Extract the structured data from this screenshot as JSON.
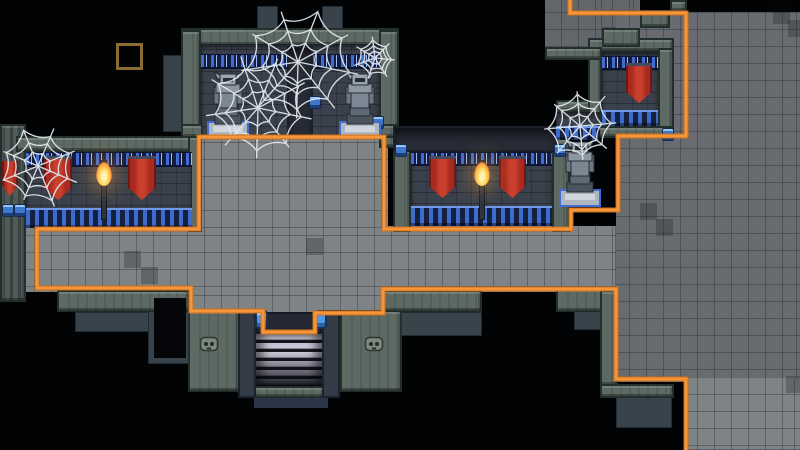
{
  "scene": {
    "width": 800,
    "height": 450,
    "colors": {
      "background": "#020304",
      "floor_light": "#7e8386",
      "floor_dark": "#686c70",
      "floor_dim": "#63676b",
      "wall_cap_green": "#5d6a64",
      "slate": "#39434c",
      "brick": "#3b414c",
      "blue_trim": "#3f6bd2",
      "banner_red": "#a82a20",
      "flame_yellow": "#ffd75e",
      "stair_light": "#c9c5d6",
      "lamp_blue": "#4f9ae6",
      "web_white": "#e3e9ef",
      "outline_orange": "#f7953a",
      "outline_orange_shadow": "#c96f1f",
      "marker_brown": "#8a6b33"
    },
    "floors": [
      {
        "rect": [
          22,
          226,
          598,
          66
        ],
        "tone": "light"
      },
      {
        "rect": [
          190,
          290,
          194,
          24
        ],
        "tone": "light"
      },
      {
        "rect": [
          258,
          312,
          66,
          24
        ],
        "tone": "light"
      },
      {
        "rect": [
          194,
          136,
          194,
          92
        ],
        "tone": "light"
      },
      {
        "rect": [
          545,
          0,
          57,
          47
        ],
        "tone": "dim"
      },
      {
        "rect": [
          602,
          0,
          38,
          28
        ],
        "tone": "dim"
      },
      {
        "rect": [
          616,
          12,
          184,
          370
        ],
        "tone": "dark"
      },
      {
        "rect": [
          686,
          378,
          114,
          72
        ],
        "tone": "light"
      }
    ],
    "dark_tiles": [
      [
        124,
        251
      ],
      [
        141,
        267
      ],
      [
        640,
        203
      ],
      [
        656,
        219
      ],
      [
        773,
        7
      ],
      [
        788,
        20
      ],
      [
        786,
        376
      ],
      [
        306,
        238
      ]
    ],
    "slates": [
      [
        163,
        55,
        20,
        77
      ],
      [
        257,
        6,
        21,
        24
      ],
      [
        322,
        6,
        21,
        24
      ],
      [
        75,
        312,
        115,
        20
      ],
      [
        148,
        292,
        44,
        72
      ],
      [
        395,
        312,
        87,
        24
      ],
      [
        574,
        302,
        28,
        28
      ],
      [
        616,
        396,
        56,
        32
      ]
    ],
    "blacks": [
      [
        154,
        298,
        32,
        60
      ]
    ],
    "pillars": [
      [
        0,
        124,
        26,
        178
      ]
    ],
    "caps": [
      [
        181,
        28,
        218,
        18
      ],
      [
        181,
        30,
        20,
        118
      ],
      [
        379,
        30,
        20,
        118
      ],
      [
        181,
        124,
        218,
        14
      ],
      [
        16,
        136,
        184,
        16
      ],
      [
        188,
        136,
        14,
        96
      ],
      [
        393,
        138,
        177,
        14
      ],
      [
        393,
        150,
        18,
        82
      ],
      [
        552,
        150,
        18,
        82
      ],
      [
        556,
        100,
        44,
        12
      ],
      [
        588,
        38,
        86,
        14
      ],
      [
        588,
        48,
        14,
        82
      ],
      [
        658,
        48,
        16,
        82
      ],
      [
        588,
        126,
        86,
        12
      ],
      [
        545,
        47,
        57,
        13
      ],
      [
        602,
        28,
        38,
        19
      ],
      [
        640,
        10,
        30,
        18
      ],
      [
        670,
        0,
        17,
        12
      ],
      [
        57,
        290,
        133,
        22
      ],
      [
        188,
        310,
        52,
        82
      ],
      [
        340,
        310,
        62,
        82
      ],
      [
        383,
        290,
        99,
        22
      ],
      [
        556,
        288,
        48,
        24
      ],
      [
        600,
        290,
        18,
        96
      ],
      [
        600,
        384,
        74,
        14
      ]
    ],
    "shadow_bands": [
      [
        393,
        126,
        164,
        26
      ]
    ],
    "walls": [
      {
        "rect": [
          26,
          152,
          166,
          76
        ],
        "band": [
          0,
          12
        ],
        "base": 18
      },
      {
        "rect": [
          201,
          44,
          178,
          94
        ],
        "band": [
          10,
          12
        ],
        "base": 0
      },
      {
        "rect": [
          411,
          152,
          141,
          74
        ],
        "band": [
          0,
          11
        ],
        "base": 18
      },
      {
        "rect": [
          556,
          112,
          44,
          28
        ],
        "band": [
          0,
          0
        ],
        "base": 12
      },
      {
        "rect": [
          602,
          52,
          56,
          74
        ],
        "band": [
          4,
          11
        ],
        "base": 14
      }
    ],
    "recesses": [
      [
        287,
        46,
        26,
        90
      ]
    ],
    "banners": [
      [
        2,
        158,
        16,
        38
      ],
      [
        44,
        156,
        28,
        44
      ],
      [
        128,
        156,
        28,
        44
      ],
      [
        429,
        156,
        27,
        42
      ],
      [
        499,
        156,
        27,
        42
      ],
      [
        626,
        63,
        26,
        40
      ]
    ],
    "torches": [
      [
        94,
        150
      ],
      [
        472,
        150
      ]
    ],
    "statues": [
      [
        206,
        70
      ],
      [
        338,
        70
      ],
      [
        558,
        138
      ]
    ],
    "faces": [
      [
        199,
        336
      ],
      [
        364,
        336
      ]
    ],
    "pots": [
      [
        2,
        204
      ],
      [
        14,
        204
      ],
      [
        372,
        116
      ],
      [
        395,
        144
      ],
      [
        554,
        144
      ],
      [
        309,
        96
      ],
      [
        662,
        128
      ]
    ],
    "stairs": {
      "landing": [
        256,
        312,
        66,
        22
      ],
      "steps": [
        256,
        334,
        66,
        52
      ],
      "left_col": [
        238,
        310,
        18,
        88
      ],
      "right_col": [
        322,
        310,
        18,
        88
      ],
      "footer_navy": [
        254,
        392,
        74,
        16
      ],
      "footer_cap": [
        246,
        386,
        94,
        12
      ],
      "lamps": [
        [
          255,
          310
        ],
        [
          314,
          310
        ]
      ]
    },
    "webs": [
      {
        "cx": 298,
        "cy": 62,
        "r": 56,
        "spokes": 9,
        "rot": 0.2
      },
      {
        "cx": 258,
        "cy": 108,
        "r": 50,
        "spokes": 9,
        "rot": 0.9
      },
      {
        "cx": 38,
        "cy": 166,
        "r": 40,
        "spokes": 8,
        "rot": 0.4
      },
      {
        "cx": 375,
        "cy": 58,
        "r": 20,
        "spokes": 7,
        "rot": 0.1
      },
      {
        "cx": 580,
        "cy": 126,
        "r": 36,
        "spokes": 8,
        "rot": 0.7
      }
    ],
    "outline_path": [
      [
        570,
        0
      ],
      [
        570,
        13
      ],
      [
        686,
        13
      ],
      [
        686,
        136
      ],
      [
        618,
        136
      ],
      [
        618,
        210
      ],
      [
        571,
        210
      ],
      [
        571,
        229
      ],
      [
        384,
        229
      ],
      [
        384,
        137
      ],
      [
        199,
        137
      ],
      [
        199,
        229
      ],
      [
        37,
        229
      ],
      [
        37,
        288
      ],
      [
        191,
        288
      ],
      [
        191,
        311
      ],
      [
        263,
        311
      ],
      [
        263,
        332
      ],
      [
        315,
        332
      ],
      [
        315,
        313
      ],
      [
        383,
        313
      ],
      [
        383,
        289
      ],
      [
        616,
        289
      ],
      [
        616,
        379
      ],
      [
        686,
        379
      ],
      [
        686,
        450
      ]
    ],
    "marker": [
      116,
      43,
      27,
      27
    ]
  }
}
